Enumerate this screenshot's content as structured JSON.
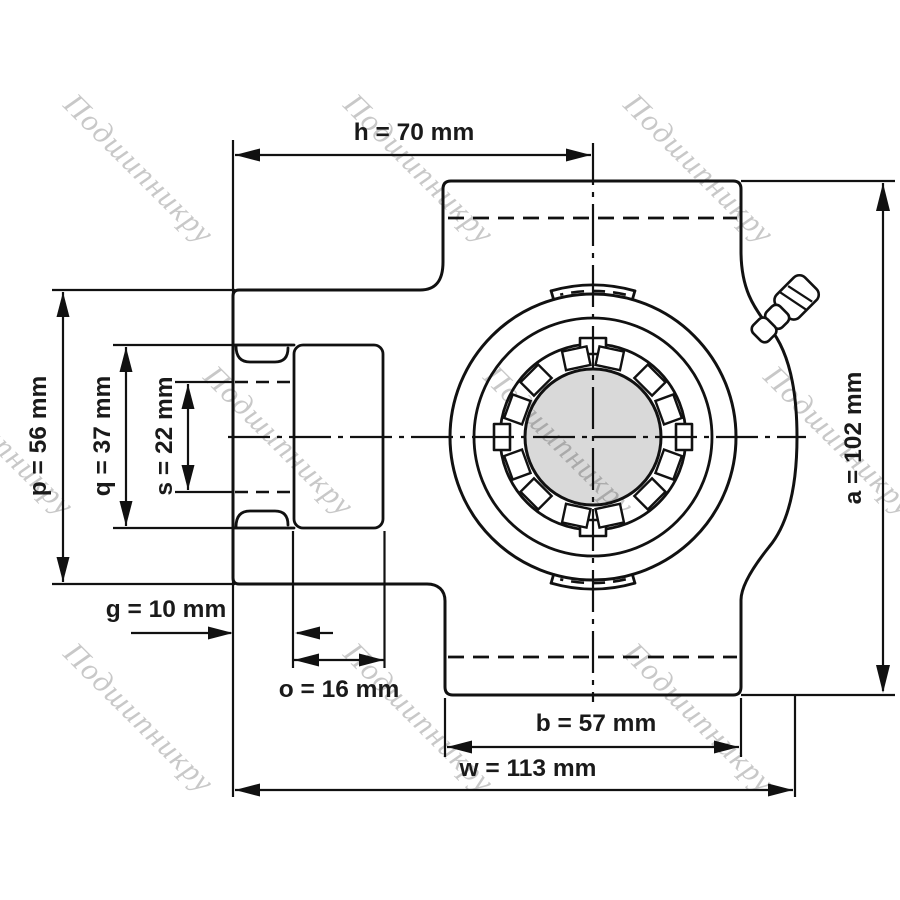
{
  "figure": {
    "background": "#ffffff",
    "line_color": "#111111",
    "shaft_fill": "#d9d9d9",
    "text_color": "#1a1a1a",
    "watermark_color": "#c8c8c8"
  },
  "watermark": {
    "text": "Подшипникру"
  },
  "dimensions": {
    "h": {
      "letter": "h",
      "value": 70,
      "unit": "mm",
      "label": "h = 70 mm"
    },
    "a": {
      "letter": "a",
      "value": 102,
      "unit": "mm",
      "label": "a = 102 mm"
    },
    "p": {
      "letter": "p",
      "value": 56,
      "unit": "mm",
      "label": "p = 56 mm"
    },
    "q": {
      "letter": "q",
      "value": 37,
      "unit": "mm",
      "label": "q = 37 mm"
    },
    "s": {
      "letter": "s",
      "value": 22,
      "unit": "mm",
      "label": "s = 22 mm"
    },
    "g": {
      "letter": "g",
      "value": 10,
      "unit": "mm",
      "label": "g = 10 mm"
    },
    "o": {
      "letter": "o",
      "value": 16,
      "unit": "mm",
      "label": "o = 16 mm"
    },
    "b": {
      "letter": "b",
      "value": 57,
      "unit": "mm",
      "label": "b = 57 mm"
    },
    "w": {
      "letter": "w",
      "value": 113,
      "unit": "mm",
      "label": "w = 113 mm"
    }
  }
}
